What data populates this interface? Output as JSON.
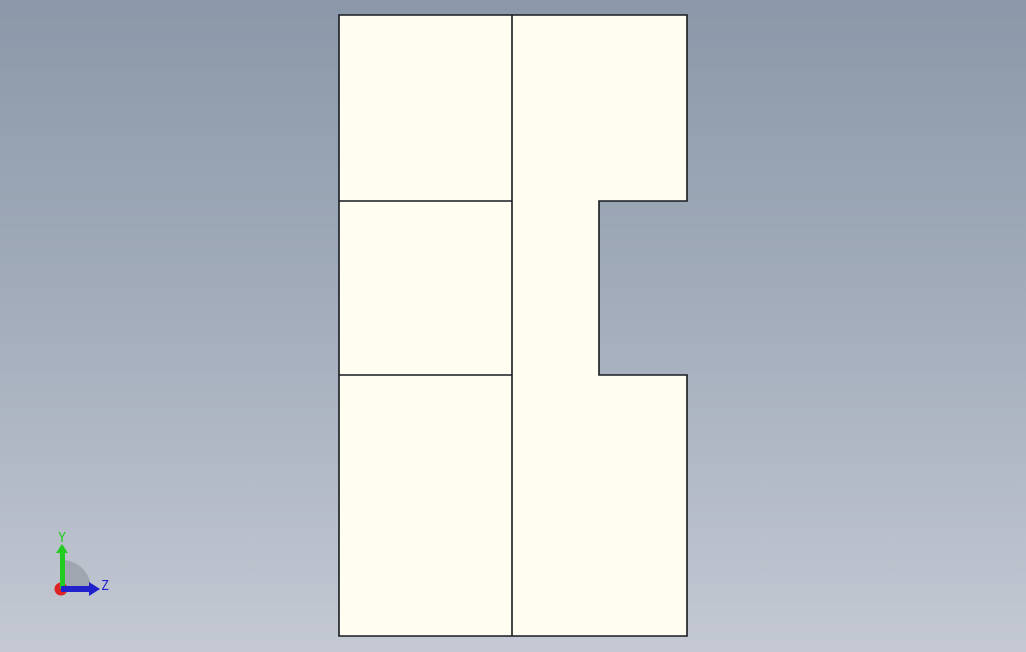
{
  "viewport": {
    "background_top": "#8b98a9",
    "background_middle": "#a4aebc",
    "background_bottom": "#c4c9d3"
  },
  "part": {
    "fill": "#fffef0",
    "edge_color": "#161a20"
  },
  "triad": {
    "y_label": "Y",
    "z_label": "Z",
    "y_axis_color": "#22cc22",
    "z_axis_color": "#2222cc",
    "x_origin_color": "#dd2222",
    "sector_color": "#9aa1aa"
  }
}
